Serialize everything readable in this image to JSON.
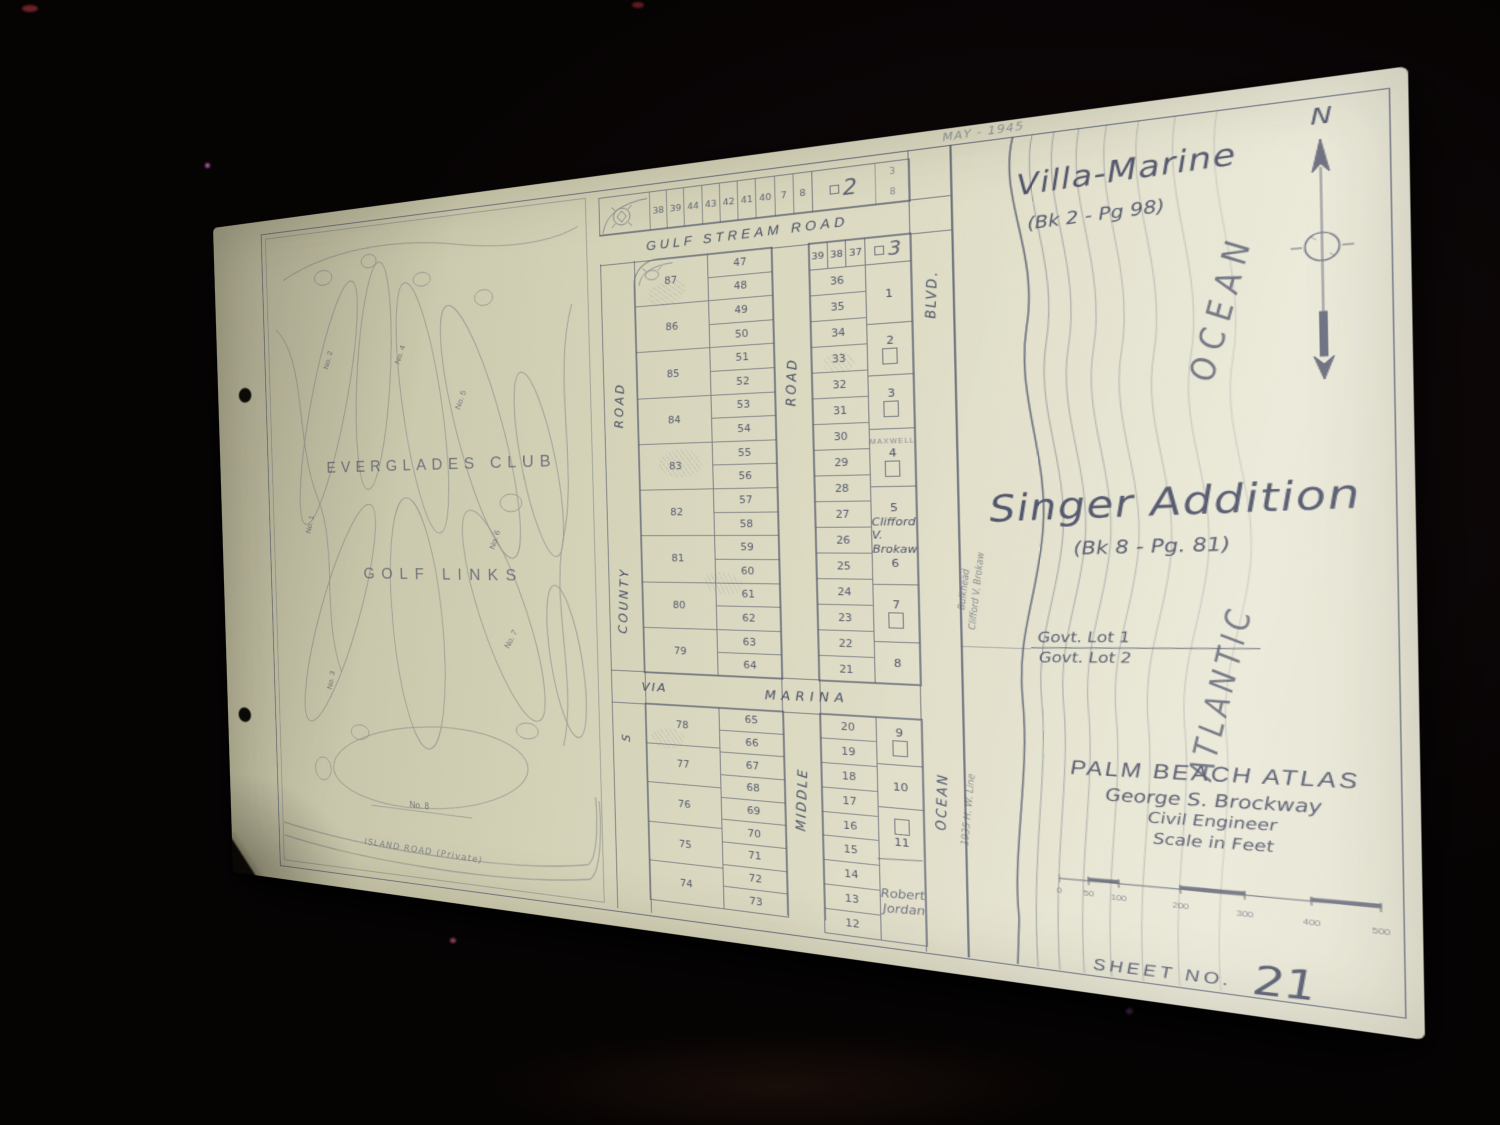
{
  "colors": {
    "paper": "#dddbc3",
    "ink": "#4a4f66",
    "background": "#060303"
  },
  "header": {
    "date_note": "MAY - 1945"
  },
  "villa_marine": {
    "title": "Villa-Marine",
    "reference": "(Bk 2 - Pg 98)"
  },
  "singer_addition": {
    "title": "Singer Addition",
    "reference": "(Bk 8 - Pg. 81)"
  },
  "compass": {
    "north_label": "N"
  },
  "sea": {
    "ocean_label": "OCEAN",
    "atlantic_label": "ATLANTIC"
  },
  "notes": {
    "bulkhead_line1": "Bulkhead",
    "bulkhead_line2": "Clifford V. Brokaw",
    "high_water_line": "1935 H. W. Line",
    "govt_lot_1": "Govt. Lot 1",
    "govt_lot_2": "Govt. Lot 2"
  },
  "atlas": {
    "title": "PALM BEACH ATLAS",
    "author": "George S. Brockway",
    "role": "Civil Engineer",
    "scale_caption": "Scale in Feet",
    "scale_ticks": [
      "0",
      "50",
      "100",
      "200",
      "300",
      "400",
      "500"
    ]
  },
  "sheet": {
    "label": "SHEET NO.",
    "number": "21"
  },
  "golf": {
    "club_line1": "EVERGLADES CLUB",
    "club_line2": "GOLF LINKS",
    "holes": [
      "No. 1",
      "No. 2",
      "No. 3",
      "No. 4",
      "No. 5",
      "No. 6",
      "No. 7",
      "No. 8"
    ],
    "island_road": "ISLAND ROAD (Private)"
  },
  "roads": {
    "gulf_stream": "GULF STREAM ROAD",
    "county_prefix": "S",
    "county": "COUNTY",
    "county_suffix": "ROAD",
    "middle_upper": "ROAD",
    "middle_lower": "MIDDLE",
    "via": "VIA",
    "marina": "MARINA",
    "ocean_blvd": "BLVD.",
    "ocean_lower": "OCEAN"
  },
  "plat": {
    "block2_label": "2",
    "block3_label": "3",
    "top_lots": [
      "38",
      "39",
      "44",
      "43",
      "42",
      "41",
      "40",
      "7",
      "8"
    ],
    "top_end_lots": [
      "3",
      "8"
    ],
    "col1_large": [
      "87",
      "86",
      "85",
      "84",
      "83",
      "82",
      "81",
      "80",
      "79"
    ],
    "col1_small": [
      "47",
      "48",
      "49",
      "50",
      "51",
      "52",
      "53",
      "54",
      "55",
      "56",
      "57",
      "58",
      "59",
      "60",
      "61",
      "62",
      "63",
      "64"
    ],
    "col2_header": [
      "39",
      "38",
      "37"
    ],
    "col2_small": [
      "36",
      "35",
      "34",
      "33",
      "32",
      "31",
      "30",
      "29",
      "28",
      "27",
      "26",
      "25",
      "24",
      "23",
      "22",
      "21"
    ],
    "lot1": "1",
    "lot2": "2",
    "lot3": "3",
    "lot4": "4",
    "lot4_name": "MAXWELL",
    "lot5": "5",
    "brokaw_line1": "Clifford V.",
    "brokaw_line2": "Brokaw",
    "lot6": "6",
    "lot7": "7",
    "lot8": "8",
    "bottom_col1_large": [
      "78",
      "77",
      "76",
      "75",
      "74"
    ],
    "bottom_col1_small": [
      "65",
      "66",
      "67",
      "68",
      "69",
      "70",
      "71",
      "72",
      "73"
    ],
    "bottom_col2_small": [
      "20",
      "19",
      "18",
      "17",
      "16",
      "15",
      "14",
      "13",
      "12"
    ],
    "lot9": "9",
    "lot10": "10",
    "lot11": "11",
    "jordan_line1": "Robert",
    "jordan_line2": "Jordan"
  }
}
